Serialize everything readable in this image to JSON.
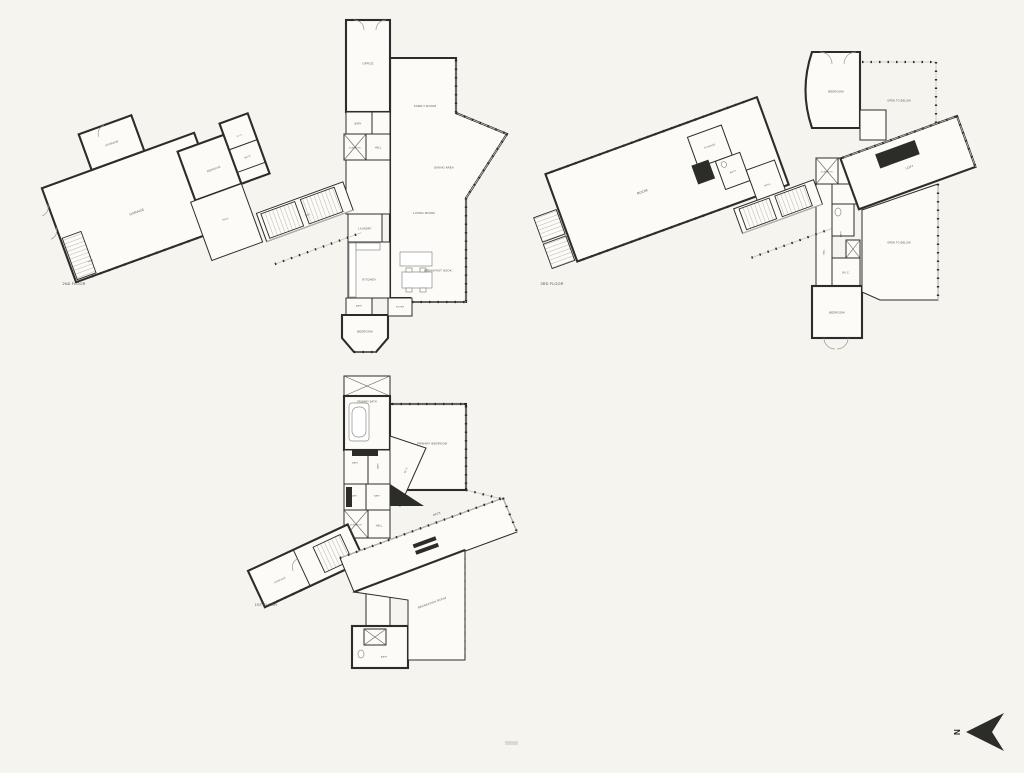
{
  "canvas": {
    "background": "#f5f4ee",
    "wall_ink": "#2c2c29",
    "room_fill": "#fcfbf8",
    "label_color": "#52524d"
  },
  "rooms": {
    "storage": "STORAGE",
    "garage": "GARAGE",
    "bedroom": "BEDROOM",
    "bath": "BATH",
    "wic": "W.I.C.",
    "hall": "HALL",
    "office": "OFFICE",
    "elevator": "ELEVATOR",
    "family_room": "FAMILY ROOM",
    "dining_area": "DINING AREA",
    "living_room": "LIVING ROOM",
    "laundry": "LAUNDRY",
    "kitchen": "KITCHEN",
    "breakfast_nook": "BREAKFAST NOOK",
    "foyer": "FOYER",
    "room": "ROOM",
    "open_to_below": "OPEN TO BELOW",
    "loft": "LOFT",
    "primary_bath": "PRIMARY BATH",
    "primary_bedroom": "PRIMARY BEDROOM",
    "deck": "DECK",
    "closet": "CLOSET",
    "recreation_room": "RECREATION ROOM"
  },
  "floors": {
    "first": "1ST FLOOR",
    "second": "2ND FLOOR",
    "third": "3RD FLOOR"
  },
  "compass": {
    "north": "N"
  }
}
